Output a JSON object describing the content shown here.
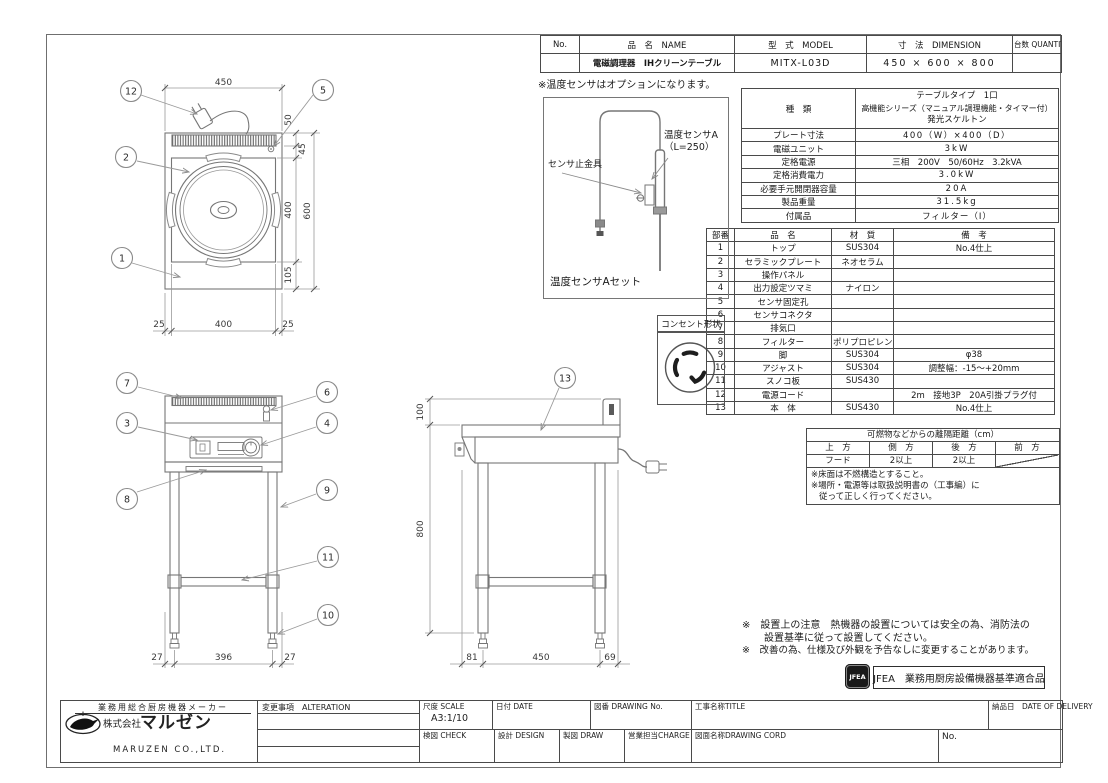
{
  "header_table": {
    "col_no": "No.",
    "col_name": "品　名　NAME",
    "col_model": "型　式　MODEL",
    "col_dim": "寸　法　DIMENSION",
    "col_qty": "台数 QUANTITY",
    "name": "電磁調理器　IHクリーンテーブル",
    "model": "MITX-L03D",
    "dimension": "450 × 600 × 800",
    "quantity": ""
  },
  "spec_table": {
    "kind_label": "種　類",
    "kind_line1": "テーブルタイプ　1口",
    "kind_line2": "高機能シリーズ（マニュアル調理機能・タイマー付）",
    "kind_line3": "発光スケルトン",
    "rows": [
      {
        "label": "プレート寸法",
        "value": "400（W）×400（D）"
      },
      {
        "label": "電磁ユニット",
        "value": "3kW"
      },
      {
        "label": "定格電源",
        "value": "三相　200V　50/60Hz　3.2kVA"
      },
      {
        "label": "定格消費電力",
        "value": "3.0kW"
      },
      {
        "label": "必要手元開閉器容量",
        "value": "20A"
      },
      {
        "label": "製品重量",
        "value": "31.5kg"
      },
      {
        "label": "付属品",
        "value": "フィルター（I）"
      }
    ]
  },
  "parts_table": {
    "col_no": "部番",
    "col_name": "品　名",
    "col_material": "材　質",
    "col_note": "備　考",
    "rows": [
      {
        "no": "1",
        "name": "トップ",
        "material": "SUS304",
        "note": "No.4仕上"
      },
      {
        "no": "2",
        "name": "セラミックプレート",
        "material": "ネオセラム",
        "note": ""
      },
      {
        "no": "3",
        "name": "操作パネル",
        "material": "",
        "note": ""
      },
      {
        "no": "4",
        "name": "出力設定ツマミ",
        "material": "ナイロン",
        "note": ""
      },
      {
        "no": "5",
        "name": "センサ固定孔",
        "material": "",
        "note": ""
      },
      {
        "no": "6",
        "name": "センサコネクタ",
        "material": "",
        "note": ""
      },
      {
        "no": "7",
        "name": "排気口",
        "material": "",
        "note": ""
      },
      {
        "no": "8",
        "name": "フィルター",
        "material": "ポリプロピレン",
        "note": ""
      },
      {
        "no": "9",
        "name": "脚",
        "material": "SUS304",
        "note": "φ38"
      },
      {
        "no": "10",
        "name": "アジャスト",
        "material": "SUS304",
        "note": "調整幅：-15～+20mm"
      },
      {
        "no": "11",
        "name": "スノコ板",
        "material": "SUS430",
        "note": ""
      },
      {
        "no": "12",
        "name": "電源コード",
        "material": "",
        "note": "2m　接地3P　20A引掛プラグ付"
      },
      {
        "no": "13",
        "name": "本　体",
        "material": "SUS430",
        "note": "No.4仕上"
      }
    ]
  },
  "clearance_table": {
    "title": "可燃物などからの離隔距離（cm）",
    "col1": "上　方",
    "col2": "側　方",
    "col3": "後　方",
    "col4": "前　方",
    "val1": "フード",
    "val2": "2以上",
    "val3": "2以上",
    "note1": "※床面は不燃構造とすること。",
    "note2": "※場所・電源等は取扱説明書の（工事編）に",
    "note3": "従って正しく行ってください。"
  },
  "sensor": {
    "option_note": "※温度センサはオプションになります。",
    "label_a": "温度センサA",
    "label_a2": "（L=250）",
    "label_bracket": "センサ止金具",
    "caption": "温度センサAセット"
  },
  "outlet": {
    "label": "コンセント形状"
  },
  "notes": {
    "line1": "※　設置上の注意　熱機器の設置については安全の為、消防法の",
    "line2": "設置基準に従って設置してください。",
    "line3": "※　改善の為、仕様及び外観を予告なしに変更することがあります。",
    "jfea_logo": "JFEA",
    "jfea_text": "JFEA　業務用厨房設備機器基準適合品"
  },
  "title_block": {
    "maker_tagline": "業務用総合厨房機器メーカー",
    "company_prefix": "株式会社",
    "company_name": "マルゼン",
    "company_en": "MARUZEN CO.,LTD.",
    "alteration": "変更事項　ALTERATION",
    "scale_label": "尺度 SCALE",
    "scale_value": "A3:1/10",
    "date_label": "日付 DATE",
    "drawing_no_label": "図番 DRAWING No.",
    "title_label": "工事名称TITLE",
    "delivery_label": "納品日　DATE OF DELIVERY",
    "check_label": "検図 CHECK",
    "design_label": "設計 DESIGN",
    "draw_label": "製図 DRAW",
    "charge_label": "営業担当CHARGE",
    "drawing_cord_label": "図面名称DRAWING CORD",
    "no_label": "No."
  },
  "dims": {
    "plan": {
      "top": "450",
      "right1": "50",
      "right2": "45",
      "right3": "400",
      "right4": "105",
      "right5": "600",
      "bottom1": "25",
      "bottom2": "400",
      "bottom3": "25"
    },
    "front": {
      "bottom1": "27",
      "bottom2": "396",
      "bottom3": "27"
    },
    "side": {
      "left1": "100",
      "left2": "800",
      "bottom1": "81",
      "bottom2": "450",
      "bottom3": "69"
    }
  },
  "balloons": {
    "b1": "1",
    "b2": "2",
    "b3": "3",
    "b4": "4",
    "b5": "5",
    "b6": "6",
    "b7": "7",
    "b8": "8",
    "b9": "9",
    "b10": "10",
    "b11": "11",
    "b12": "12",
    "b13": "13"
  }
}
